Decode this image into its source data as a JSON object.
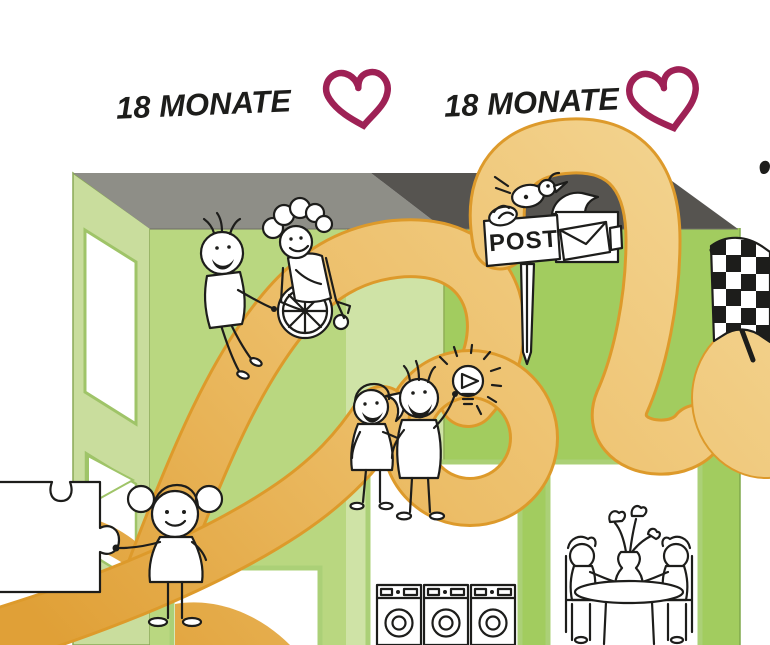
{
  "phases": [
    {
      "label": "18 MONATE"
    },
    {
      "label": "18 MONATE"
    }
  ],
  "mailbox": {
    "sign_label": "POST"
  },
  "colors": {
    "heart": "#9e2155",
    "ink": "#1d1d1b",
    "roof_left": "#8e8e87",
    "roof_right": "#565450",
    "wall_left_face": "#c9dd9d",
    "wall_front_left": "#b9d780",
    "wall_front_light_band": "#cfe3a6",
    "wall_front_right": "#a2cc5f",
    "window_border": "#abd077",
    "ribbon_edge": "#dd9a2b",
    "ribbon_dark": "#e3a23a",
    "ribbon_light": "#f4d694"
  },
  "icons": {
    "heart": "heart-icon",
    "bird": "bird-icon",
    "mailbox": "mailbox-icon",
    "envelope": "envelope-icon",
    "checkered_flag": "checkered-flag-icon",
    "lightbulb": "lightbulb-icon",
    "wheelchair": "wheelchair-icon",
    "puzzle_piece": "puzzle-piece-icon",
    "washing_machine": "washing-machine-icon",
    "dining_table": "dining-table-icon"
  }
}
